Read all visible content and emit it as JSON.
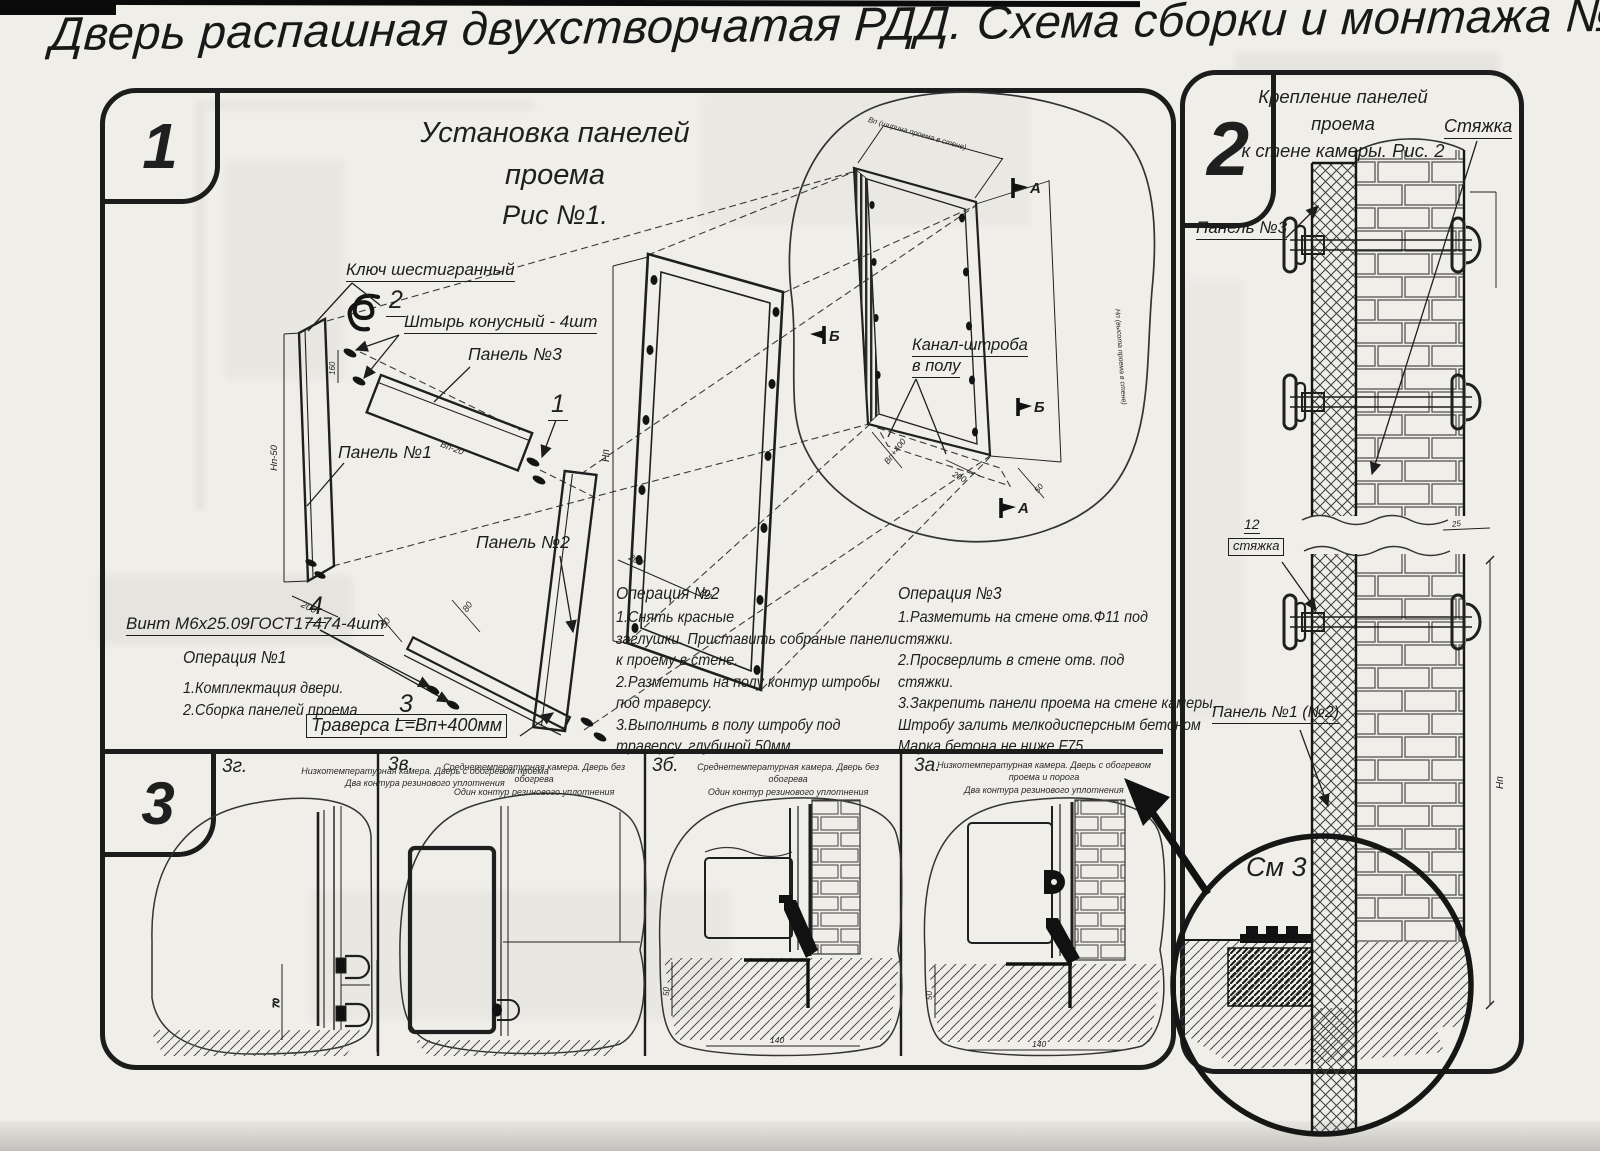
{
  "title": "Дверь распашная двухстворчатая РДД.  Схема сборки и монтажа №2",
  "section1": {
    "badge": "1",
    "heading_line1": "Установка панелей проема",
    "heading_line2": "Рис №1.",
    "callout_panel": "1",
    "callout_pin": "2",
    "callout_traverse": "3",
    "callout_screw": "4",
    "labels": {
      "hex_key": "Ключ шестигранный",
      "pin": "Штырь конусный - 4шт",
      "panel3": "Панель №3",
      "panel1": "Панель №1",
      "panel2": "Панель №2",
      "screw": "Винт М6х25.09ГОСТ17474-4шт",
      "traverse": "Траверса  L=Bп+400мм",
      "channel_line1": "Канал-штроба",
      "channel_line2": "в полу"
    },
    "markers": {
      "a": "А",
      "b": "Б"
    },
    "dims": {
      "panel1_height": "Нп-50",
      "panel1_width": "200",
      "pin_spacing": "160",
      "panel3_width": "Вп-20",
      "traverse_d80": "80",
      "traverse_d50": "50",
      "frame_height": "Нп",
      "frame_d200": "200",
      "frame_width": "Вп",
      "opening_width": "Вп (ширина проема в стене)",
      "opening_height": "Нп (высота проема в стене)",
      "traverse_length": "Вп+400",
      "floor_d200": "200",
      "floor_d50": "50"
    },
    "op1": {
      "title": "Операция №1",
      "line1": "1.Комплектация двери.",
      "line2": "2.Сборка панелей проема"
    },
    "op2": {
      "title": "Операция №2",
      "line1": "1.Снять красные",
      "line2": "заглушки. Приставить собраные панели",
      "line3": "к проему в стене.",
      "line4": "2.Разметить на полу контур штробы",
      "line5": "под траверсу.",
      "line6": "3.Выполнить в полу штробу под",
      "line7": "траверсу, глубиной 50мм"
    },
    "op3": {
      "title": "Операция №3",
      "line1": "1.Разметить на стене отв.Ф11 под",
      "line2": "стяжки.",
      "line3": "2.Просверлить в стене отв.  под",
      "line4": "стяжки.",
      "line5": "3.Закрепить панели проема на стене камеры.",
      "line6": "Штробу залить мелкодисперсным бетоном",
      "line7": "Марка бетона не ниже  F75."
    }
  },
  "section2": {
    "badge": "2",
    "heading_line1": "Крепление панелей проема",
    "heading_line2": "к стене камеры. Рис. 2",
    "labels": {
      "tie": "Стяжка",
      "panel3": "Панель №3",
      "tie_item_no": "12",
      "tie_item": "стяжка",
      "panel12": "Панель №1 (№2)",
      "see_detail": "См 3"
    },
    "dims": {
      "offset25": "25",
      "height": "Нп"
    }
  },
  "section3": {
    "badge": "3",
    "cells": [
      {
        "label": "3г.",
        "caption_line1": "Низкотемпературная камера. Дверь с обогревом проема",
        "caption_line2": "Два контура резинового уплотнения",
        "dim_v": "70"
      },
      {
        "label": "3в.",
        "caption_line1": "Среднетемпературная камера. Дверь без обогрева",
        "caption_line2": "Один контур резинового уплотнения"
      },
      {
        "label": "3б.",
        "caption_line1": "Среднетемпературная камера. Дверь без обогрева",
        "caption_line2": "Один контур резинового уплотнения",
        "dim_v": "50",
        "dim_h": "140"
      },
      {
        "label": "3а.",
        "caption_line1": "Низкотемпературная камера. Дверь с обогревом проема и порога",
        "caption_line2": "Два контура резинового уплотнения",
        "dim_v": "50",
        "dim_h": "140"
      }
    ]
  },
  "colors": {
    "ink": "#1f1f1f",
    "paper": "#f0eee9"
  }
}
